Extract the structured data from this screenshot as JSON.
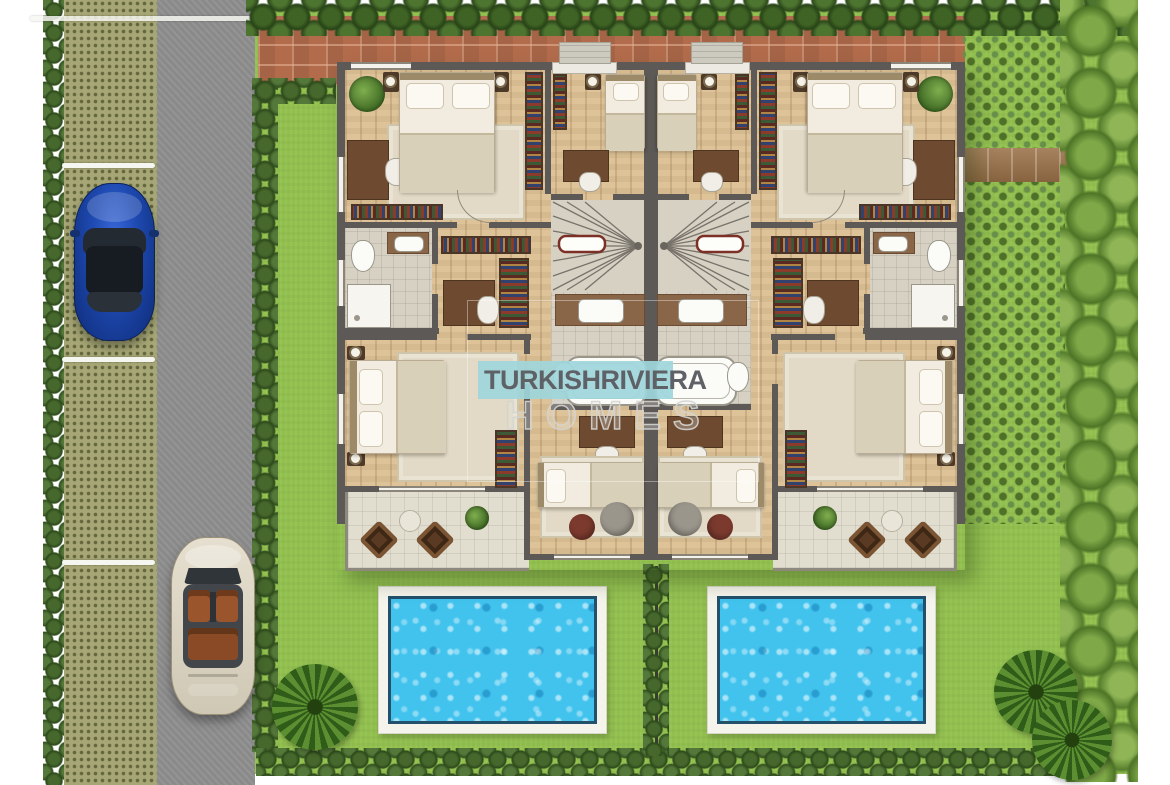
{
  "watermark": {
    "turkish": "TURKISH",
    "riviera": "RIVIERA",
    "homes": "HOMES"
  },
  "scene": {
    "type": "site / floor plan, top-down view",
    "elements": [
      "twin mirrored villa floor plan",
      "two swimming pools",
      "grass-paver parking strip",
      "asphalt road",
      "blue car parked",
      "beige convertible on road",
      "hedge rows",
      "palm trees",
      "brick patio",
      "garden shrub beds",
      "wooden garden path"
    ]
  },
  "palette": {
    "grass": "#92c04f",
    "road": "#909090",
    "parking": "#a6a676",
    "hedge_dark": "#33511f",
    "tree_light": "#7fa848",
    "brick": "#b26c4c",
    "wall": "#5d5956",
    "wood_floor": "#dcc094",
    "tile_floor": "#d6d1c3",
    "terrace": "#e1ddcf",
    "rug": "#e2dac6",
    "bookshelf": "#5a2a22",
    "pool_deck": "#f4f3ec",
    "pool_rim": "#23506b",
    "pool_water": "#41c3ee",
    "watermark_teal": "#9dd8de",
    "watermark_text": "#5e6266",
    "car_blue": "#1e4ab2",
    "car_convertible": "#d8d1bf",
    "seats_leather": "#9a552c"
  }
}
